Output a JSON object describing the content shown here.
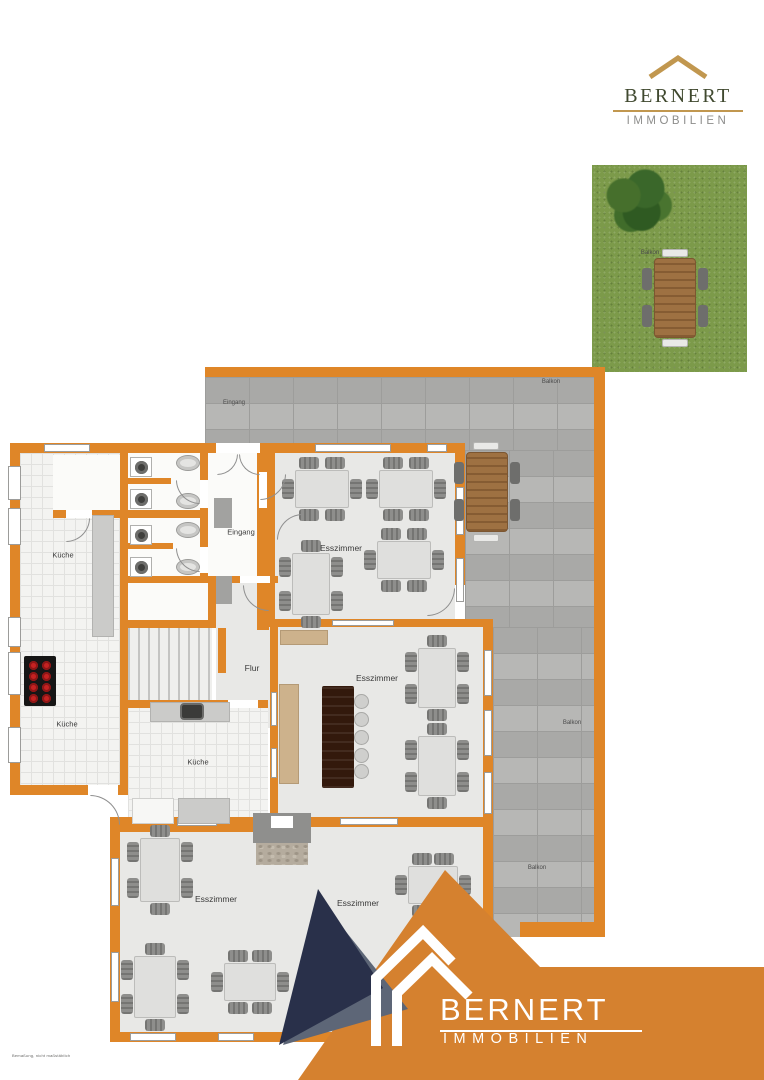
{
  "branding_top": {
    "name": "BERNERT",
    "subtitle": "IMMOBILIEN"
  },
  "branding_bottom": {
    "name": "BERNERT",
    "subtitle": "IMMOBILIEN"
  },
  "floorplan": {
    "labels": {
      "kueche_upper": "Küche",
      "kueche_lower": "Küche",
      "kueche_middle": "Küche",
      "esszimmer_top": "Esszimmer",
      "esszimmer_middle": "Esszimmer",
      "esszimmer_bottom": "Esszimmer",
      "esszimmer_bottom_b": "Esszimmer",
      "eingang_foyer": "Eingang",
      "eingang_balcony": "Eingang",
      "flur": "Flur",
      "balkon_top": "Balkon",
      "balkon_right_mid": "Balkon",
      "balkon_right_low": "Balkon",
      "balkon_garden": "Balkon"
    },
    "footnote": "Bemaßung, nicht maßstäblich"
  },
  "colors": {
    "wall": "#DF8628",
    "brand": "#D5812F",
    "navy": "#29304A",
    "steel": "#5D6677",
    "gold": "#C1974F",
    "logo_green": "#40492F",
    "logo_gray": "#8D8D8B",
    "grass": "#7C9A4A"
  }
}
